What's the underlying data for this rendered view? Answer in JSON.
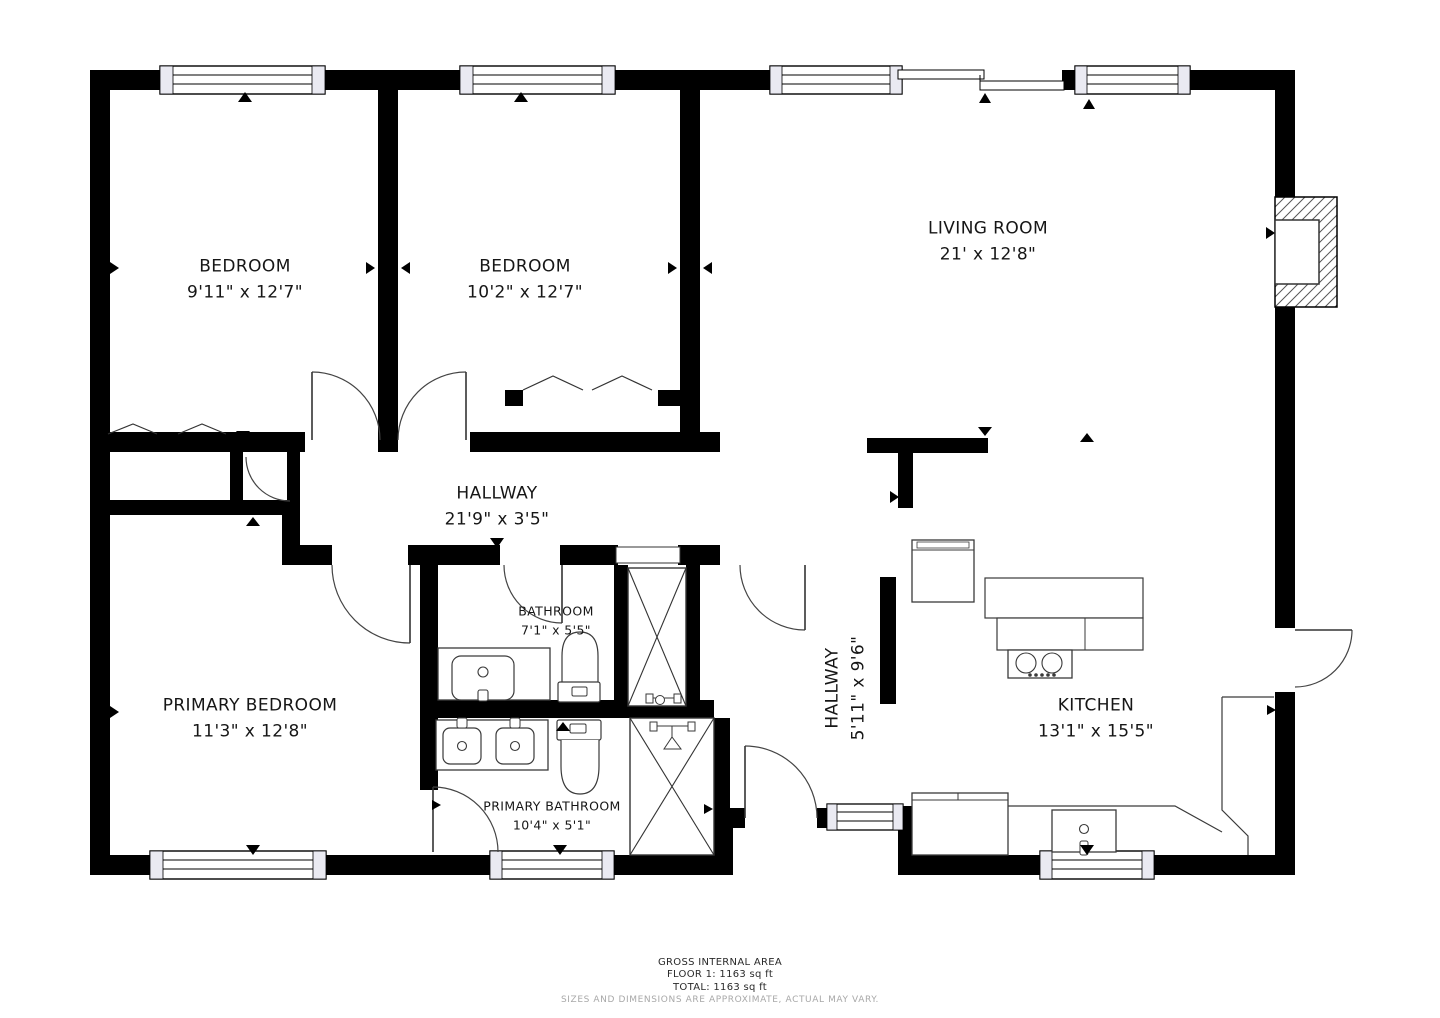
{
  "plan": {
    "rooms": [
      {
        "name": "BEDROOM",
        "dims": "9'11\" x 12'7\""
      },
      {
        "name": "BEDROOM",
        "dims": "10'2\" x 12'7\""
      },
      {
        "name": "LIVING ROOM",
        "dims": "21' x 12'8\""
      },
      {
        "name": "HALLWAY",
        "dims": "21'9\" x 3'5\""
      },
      {
        "name": "PRIMARY BEDROOM",
        "dims": "11'3\" x 12'8\""
      },
      {
        "name": "BATHROOM",
        "dims": "7'1\" x 5'5\""
      },
      {
        "name": "HALLWAY",
        "dims": "5'11\" x 9'6\""
      },
      {
        "name": "KITCHEN",
        "dims": "13'1\" x 15'5\""
      },
      {
        "name": "PRIMARY BATHROOM",
        "dims": "10'4\" x 5'1\""
      }
    ],
    "footer": {
      "title": "GROSS INTERNAL AREA",
      "floor": "FLOOR 1: 1163 sq ft",
      "total": "TOTAL: 1163 sq ft",
      "disclaimer": "SIZES AND DIMENSIONS ARE APPROXIMATE, ACTUAL MAY VARY."
    },
    "colors": {
      "wall": "#000000",
      "fixture": "#3a3a3a",
      "text": "#161616",
      "muted": "#a8a8a8"
    }
  }
}
